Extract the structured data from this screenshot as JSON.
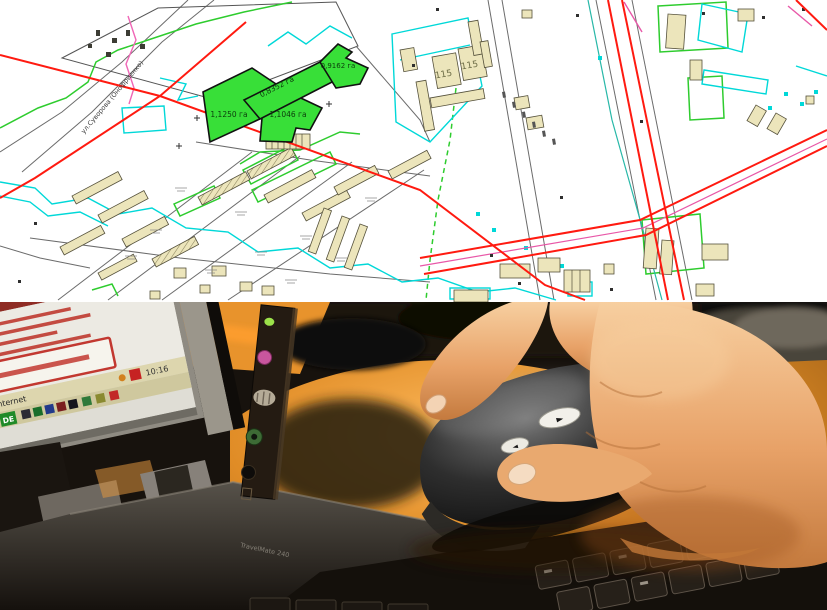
{
  "scene": {
    "description": "Cadastral plan with highlighted land parcels above a photo of a hand on a computer mouse beside a laptop"
  },
  "map": {
    "parcels": [
      {
        "area_label": "1,1250 га"
      },
      {
        "area_label": "1,1046 га"
      },
      {
        "area_label": "0,8352 га"
      },
      {
        "area_label": "0,9162 га"
      }
    ],
    "street_label": "ул.Суворова (Онофриенко)",
    "building_labels": [
      "115",
      "115"
    ],
    "colors": {
      "parcel_fill": "#38df38",
      "road_red": "#ff1a10",
      "utility_cyan": "#00d8d8",
      "boundary_green": "#2ecc2e",
      "pipeline_magenta": "#f066b6",
      "building_fill": "#ece5bb"
    }
  },
  "photo": {
    "laptop": {
      "screen": {
        "taskbar_label": "Internet",
        "clock": "10:16",
        "language_badge": "DE"
      },
      "body_label": "TravelMate 240"
    },
    "mouse": {
      "back_button_glyph": "◄",
      "forward_button_glyph": "►"
    },
    "colors": {
      "desk_wood": "#e08c26",
      "mouse_body": "#151515",
      "skin_tone": "#e8a268"
    }
  }
}
